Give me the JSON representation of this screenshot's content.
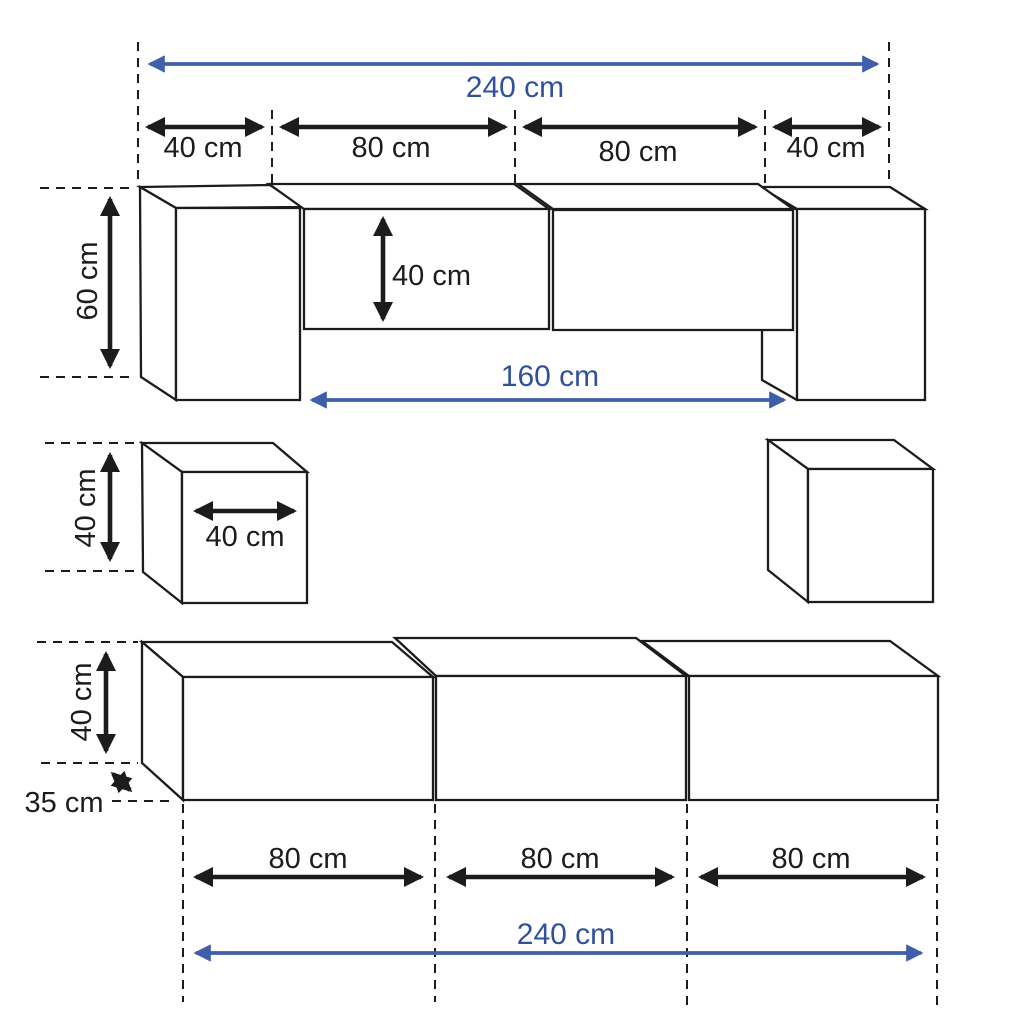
{
  "figure": {
    "type": "furniture-dimension-diagram",
    "units": "cm",
    "colors": {
      "accent_blue_text": "#31519c",
      "accent_blue_arrow": "#3f5fab",
      "line": "#1c1c1c",
      "background": "#ffffff"
    },
    "labels": {
      "top_total": "240 cm",
      "top_segments": [
        "40 cm",
        "80 cm",
        "80 cm",
        "40 cm"
      ],
      "row1_side_height": "60 cm",
      "row1_cabinet_height": "40 cm",
      "row1_cabinet_span": "160 cm",
      "row2_cube_height": "40 cm",
      "row2_cube_width": "40 cm",
      "row3_cabinet_height": "40 cm",
      "row3_cabinet_depth": "35 cm",
      "row3_segments": [
        "80 cm",
        "80 cm",
        "80 cm"
      ],
      "bottom_total": "240 cm"
    },
    "measurements_cm": {
      "top_total_width": 240,
      "top_segment_widths": [
        40,
        80,
        80,
        40
      ],
      "row1_side_unit_height": 60,
      "row1_hanging_cabinet_height": 40,
      "row1_hanging_cabinet_span": 160,
      "row2_cube_height": 40,
      "row2_cube_width": 40,
      "row3_cabinet_height": 40,
      "row3_cabinet_depth": 35,
      "row3_segment_widths": [
        80,
        80,
        80
      ],
      "bottom_total_width": 240
    }
  }
}
